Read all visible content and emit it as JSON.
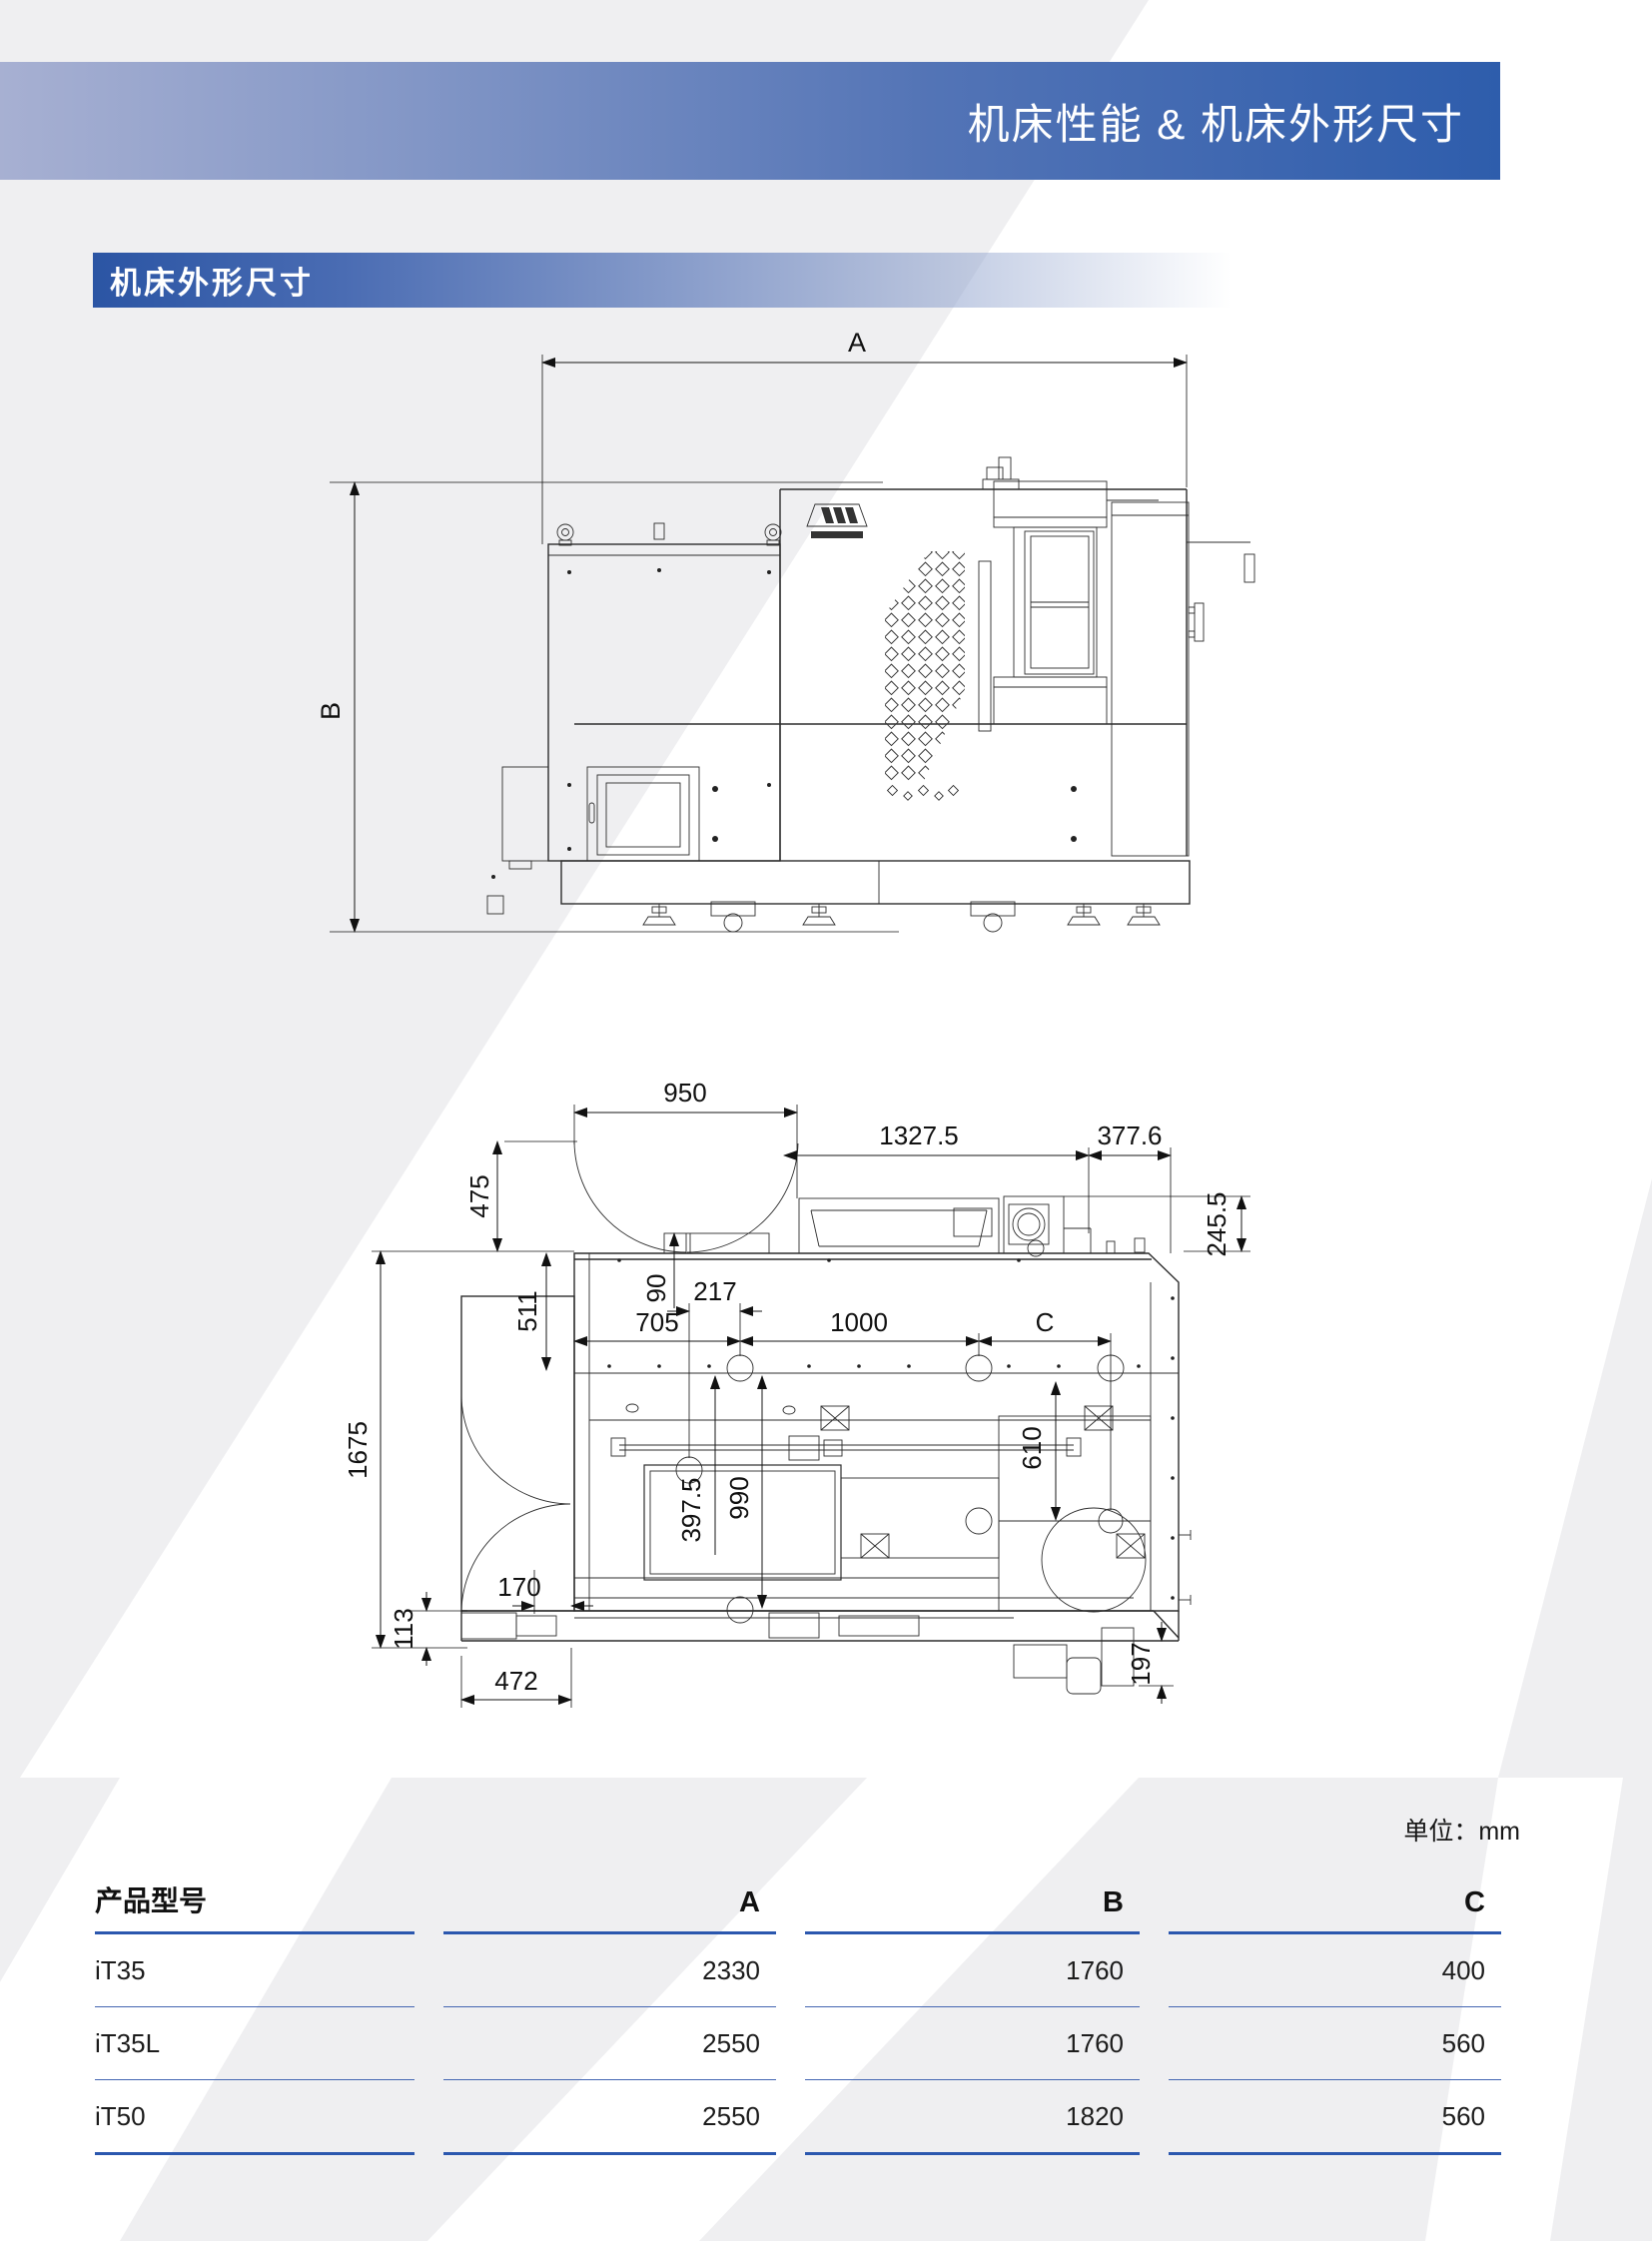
{
  "header": {
    "title": "机床性能 & 机床外形尺寸"
  },
  "section": {
    "title": "机床外形尺寸"
  },
  "front_view": {
    "dims": {
      "a": "A",
      "b": "B"
    }
  },
  "top_view": {
    "dims": {
      "d950": "950",
      "d1327_5": "1327.5",
      "d377_6": "377.6",
      "d475": "475",
      "d245_5": "245.5",
      "d90": "90",
      "d217": "217",
      "d705": "705",
      "d1000": "1000",
      "dc": "C",
      "d511": "511",
      "d1675": "1675",
      "d113": "113",
      "d170": "170",
      "d472": "472",
      "d397_5": "397.5",
      "d990": "990",
      "d610": "610",
      "d197": "197"
    }
  },
  "units_note": "单位：mm",
  "table": {
    "accent_color": "#2b57ae",
    "headers": [
      "产品型号",
      "A",
      "B",
      "C"
    ],
    "rows": [
      {
        "model": "iT35",
        "a": "2330",
        "b": "1760",
        "c": "400"
      },
      {
        "model": "iT35L",
        "a": "2550",
        "b": "1760",
        "c": "560"
      },
      {
        "model": "iT50",
        "a": "2550",
        "b": "1820",
        "c": "560"
      }
    ]
  }
}
